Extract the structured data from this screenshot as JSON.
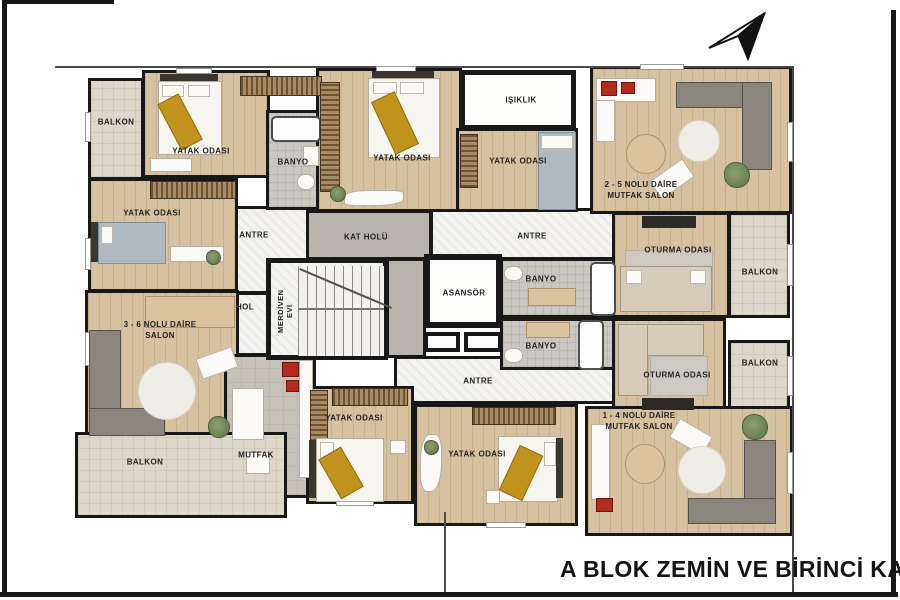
{
  "title": "A BLOK ZEMİN VE BİRİNCİ KAT PLANI",
  "colors": {
    "wall": "#181818",
    "wood_floor": "#d6c1a0",
    "tile_floor": "#ddd8ca",
    "gold_accent": "#c1931c",
    "paper": "#ffffff"
  },
  "units": {
    "unit_2_5": {
      "name": "2 - 5 NOLU DAİRE",
      "room": "MUTFAK SALON"
    },
    "unit_3_6": {
      "name": "3 - 6 NOLU DAİRE",
      "room": "SALON"
    },
    "unit_1_4": {
      "name": "1 - 4 NOLU DAİRE",
      "room": "MUTFAK SALON"
    }
  },
  "labels": {
    "balkon_tl": "BALKON",
    "yatak_tl": "YATAK ODASI",
    "banyo_l": "BANYO",
    "yatak_l2": "YATAK ODASI",
    "antre_l": "ANTRE",
    "hol": "HOL",
    "mutfak": "MUTFAK",
    "balkon_bl": "BALKON",
    "yatak_tc": "YATAK ODASI",
    "isiklik": "IŞIKLIK",
    "yatak_tr": "YATAK ODASI",
    "kat_holu": "KAT HOLÜ",
    "merdiven_1": "MERDİVEN",
    "merdiven_2": "EVİ",
    "asansor": "ASANSÖR",
    "antre_ur": "ANTRE",
    "banyo_u": "BANYO",
    "banyo_d": "BANYO",
    "antre_b": "ANTRE",
    "oturma_u": "OTURMA ODASI",
    "balkon_r1": "BALKON",
    "oturma_d": "OTURMA ODASI",
    "balkon_r2": "BALKON",
    "yatak_b1": "YATAK ODASI",
    "yatak_b2": "YATAK ODASI"
  }
}
